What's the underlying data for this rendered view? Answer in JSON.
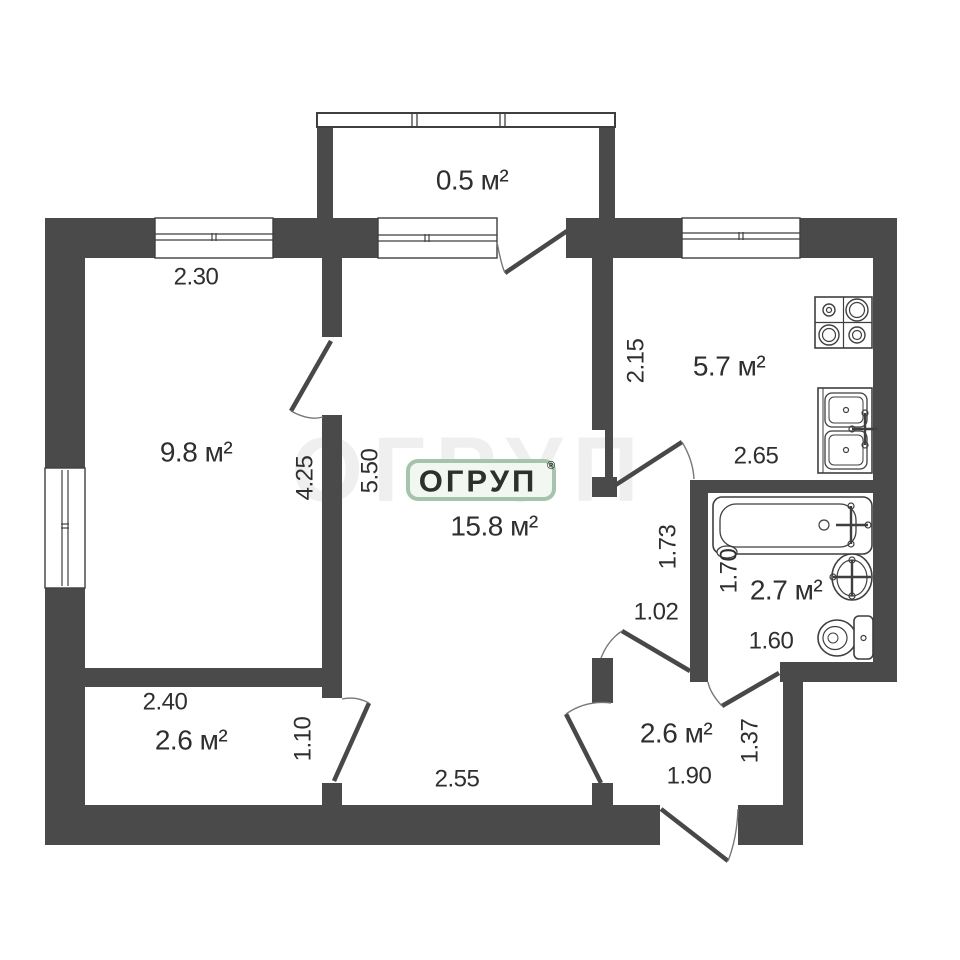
{
  "colors": {
    "wall": "#4a4a4a",
    "line": "#3f3f3f",
    "arc": "#777777",
    "text": "#2f2f2f",
    "watermark_green": "#a6c3ae",
    "watermark_bg": "#f2f7f2"
  },
  "watermark": {
    "text": "ОГРУП",
    "registered": "®"
  },
  "labels": {
    "balcony_area": "0.5 м²",
    "bedroom_width": "2.30",
    "bedroom_area": "9.8 м²",
    "bedroom_length": "4.25",
    "living_length": "5.50",
    "living_area": "15.8 м²",
    "living_width": "2.55",
    "kitchen_wall": "2.15",
    "kitchen_area": "5.7 м²",
    "kitchen_width": "2.65",
    "nook_length": "1.73",
    "nook_width": "1.02",
    "bath_length": "1.70",
    "bath_area": "2.7 м²",
    "bath_width": "1.60",
    "storage_width": "2.40",
    "storage_area": "2.6 м²",
    "storage_height": "1.10",
    "hall_area": "2.6 м²",
    "hall_width": "1.90",
    "hall_height": "1.37"
  },
  "fixtures": [
    "stove-icon",
    "kitchen-sink-icon",
    "bathtub-icon",
    "washbasin-icon",
    "toilet-icon"
  ]
}
